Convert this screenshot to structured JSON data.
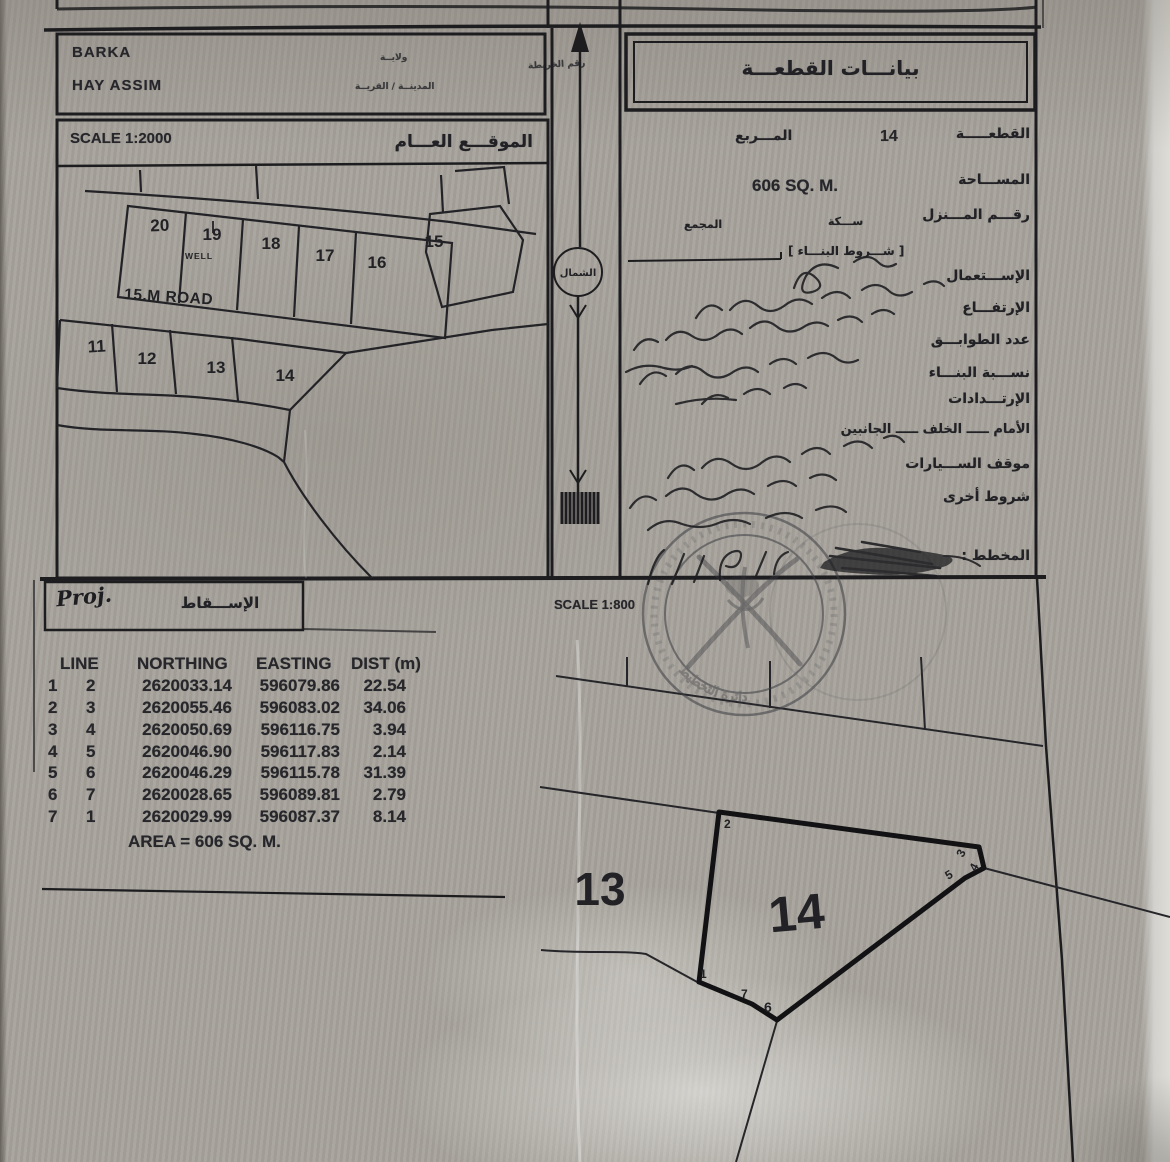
{
  "doc": {
    "town": "BARKA",
    "village": "HAY ASSIM",
    "wilaya_label": "ولايــة",
    "village_label": "المدينــة / القريــة",
    "map_no_label": "رقم الخريطة",
    "panel_title": "بيانـــات القطعـــة",
    "plot_label": "القطعـــــة",
    "plot_number": "14",
    "block_label": "المـــربع",
    "area_label": "المســـاحة",
    "area_value": "606 SQ. M.",
    "house_label": "رقـــم المـــنزل",
    "street_label": "ســـكة",
    "complex_label": "المجمع",
    "conditions_label": "[ شـــروط البنـــاء ]",
    "usage_label": "الإســـتعمال",
    "height_label": "الإرتفـــاع",
    "floors_label": "عدد الطوابـــق",
    "ratio_label": "نســـبة البنـــاء",
    "setbacks_label": "الإرتـــدادات",
    "front_back_sides": "الأمام ـــــ الخلف ـــــ الجانبين",
    "parking_label": "موقف الســـيارات",
    "other_label": "شروط أخرى",
    "planner_label": "المخطط :"
  },
  "map": {
    "scale": "SCALE 1:2000",
    "title": "الموقـــع العـــام",
    "road": "15.M ROAD",
    "well": "WELL",
    "p20": "20",
    "p19": "19",
    "p18": "18",
    "p17": "17",
    "p16": "16",
    "p15": "15",
    "p11": "11",
    "p12": "12",
    "p13": "13",
    "p14": "14"
  },
  "north_label": "الشمال",
  "proj": {
    "handwritten": "Proj.",
    "title": "الإســـقاط",
    "scale": "SCALE 1:800"
  },
  "table": {
    "h_line": "LINE",
    "h_northing": "NORTHING",
    "h_easting": "EASTING",
    "h_dist": "DIST (m)",
    "rows": [
      [
        "1",
        "2",
        "2620033.14",
        "596079.86",
        "22.54"
      ],
      [
        "2",
        "3",
        "2620055.46",
        "596083.02",
        "34.06"
      ],
      [
        "3",
        "4",
        "2620050.69",
        "596116.75",
        "3.94"
      ],
      [
        "4",
        "5",
        "2620046.90",
        "596117.83",
        "2.14"
      ],
      [
        "5",
        "6",
        "2620046.29",
        "596115.78",
        "31.39"
      ],
      [
        "6",
        "7",
        "2620028.65",
        "596089.81",
        "2.79"
      ],
      [
        "7",
        "1",
        "2620029.99",
        "596087.37",
        "8.14"
      ]
    ],
    "area_note": "AREA = 606 SQ. M."
  },
  "diagram": {
    "plot13": "13",
    "plot14": "14",
    "v1": "1",
    "v2": "2",
    "v3": "3",
    "v4": "4",
    "v5": "5",
    "v6": "6",
    "v7": "7"
  },
  "stamp_text": "دائرة التخطيط"
}
